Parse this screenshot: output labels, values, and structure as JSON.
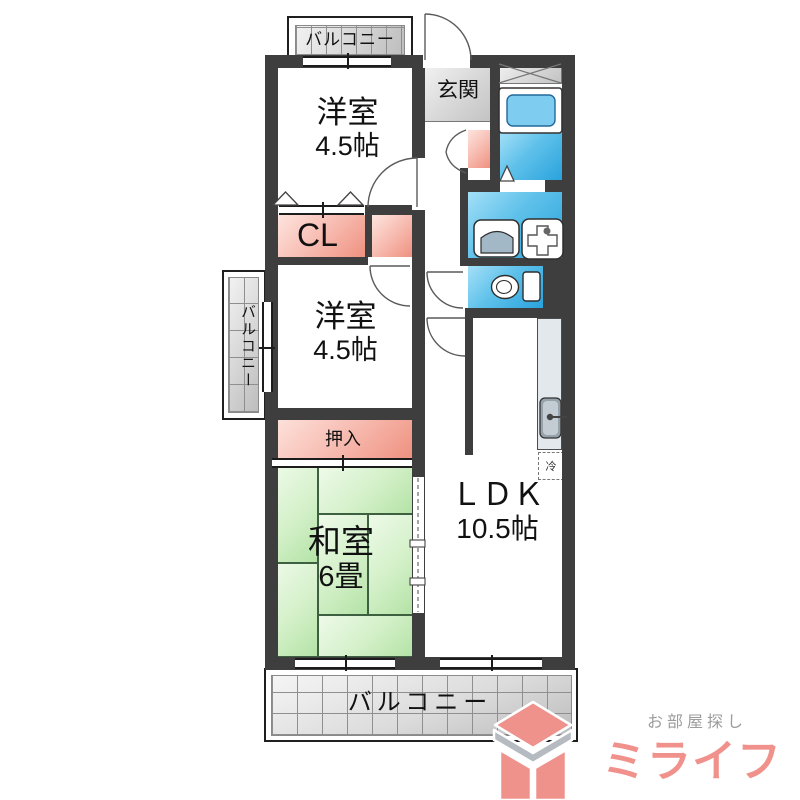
{
  "plan": {
    "rooms": {
      "western1": {
        "name": "洋室",
        "size": "4.5帖"
      },
      "western2": {
        "name": "洋室",
        "size": "4.5帖"
      },
      "japanese": {
        "name": "和室",
        "size": "6畳"
      },
      "ldk": {
        "name": "ＬＤＫ",
        "size": "10.5帖"
      },
      "entrance": {
        "name": "玄関"
      },
      "closet_cl": {
        "name": "CL"
      },
      "oshiire": {
        "name": "押入"
      },
      "refrigerator": {
        "name": "冷"
      }
    },
    "balconies": {
      "top": "バルコニー",
      "left": "バルコニー",
      "bottom": "バルコニー"
    }
  },
  "branding": {
    "tagline": "お部屋探し",
    "brand": "ミライフ"
  },
  "colors": {
    "wall": "#3e3e3e",
    "closet_pink": "#f09485",
    "wet_area_blue": "#2ea6df",
    "tatami_green": "#cdeec3",
    "brand_salmon": "#f0918b",
    "tagline_gray": "#9c9c9c"
  }
}
